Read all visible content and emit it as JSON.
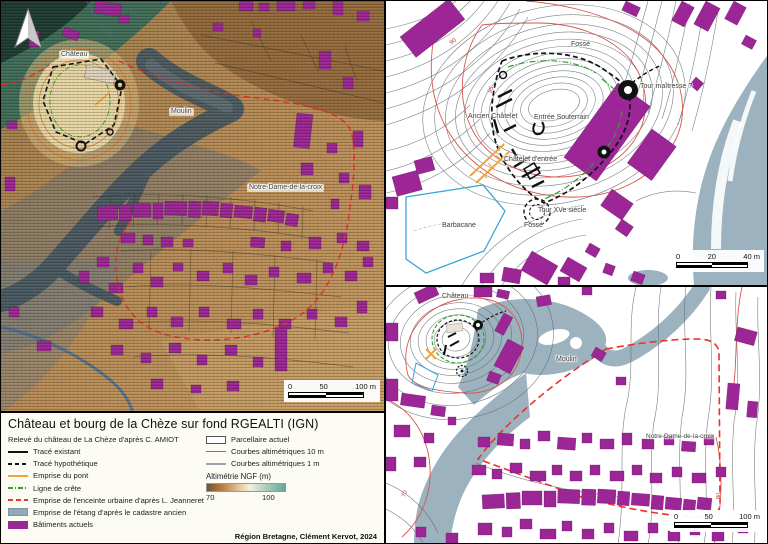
{
  "title": "Château et bourg de la Chèze sur fond RGEALTI (IGN)",
  "legend": {
    "subtitle": "Relevé du château de La Chèze d'après C. AMIOT",
    "left_items": [
      {
        "label": "Tracé existant"
      },
      {
        "label": "Tracé hypothétique"
      },
      {
        "label": "Emprise du pont"
      },
      {
        "label": "Ligne de crête"
      },
      {
        "label": "Emprise de l'enceinte urbaine d'après L. Jeanneret"
      },
      {
        "label": "Emprise de l'étang d'après le cadastre ancien"
      },
      {
        "label": "Bâtiments actuels"
      }
    ],
    "right_items": [
      {
        "label": "Parcellaire actuel"
      },
      {
        "label": "Courbes altimétriques 10 m"
      },
      {
        "label": "Courbes altimétriques 1 m"
      }
    ],
    "altimetry": {
      "label": "Altimétrie NGF (m)",
      "min": "70",
      "max": "100"
    },
    "credit": "Région Bretagne, Clément Kervot, 2024"
  },
  "maps": {
    "left": {
      "labels": {
        "chateau": "Château",
        "moulin": "Moulin",
        "ndc": "Notre-Dame-de-la-croix"
      },
      "scalebar": {
        "t0": "0",
        "t1": "50",
        "t2": "100 m"
      }
    },
    "top_right": {
      "labels": {
        "fosse_top": "Fossé",
        "tour_maitresse": "Tour maîtresse ?",
        "ancien_chatelet": "Ancien Châtelet",
        "entree_souterrain": "Entrée Souterrain",
        "chatelet_entree": "Châtelet d'entrée",
        "tour_xve": "Tour XVe siècle",
        "fosse_bottom": "Fossé",
        "barbacane": "Barbacane"
      },
      "contour_labels": {
        "c90": "90",
        "c95": "95"
      },
      "scalebar": {
        "t0": "0",
        "t1": "20",
        "t2": "40 m"
      }
    },
    "bottom_right": {
      "labels": {
        "chateau": "Château",
        "moulin": "Moulin",
        "ndc": "Notre-Dame-de-la-croix"
      },
      "contour_labels": {
        "c70": "70",
        "c80": "80"
      },
      "scalebar": {
        "t0": "0",
        "t1": "50",
        "t2": "100 m"
      }
    }
  },
  "colors": {
    "building": "#9c2696",
    "water": "#9cb2be",
    "etang_dark": "#465862",
    "etang_legend": "#92aab8",
    "contour10": "#d8544b",
    "contour1": "#5f6b70",
    "enceinte": "#e8332a",
    "crete": "#2ea12e",
    "pont": "#f2a33c",
    "barb": "#3aa5d8"
  }
}
